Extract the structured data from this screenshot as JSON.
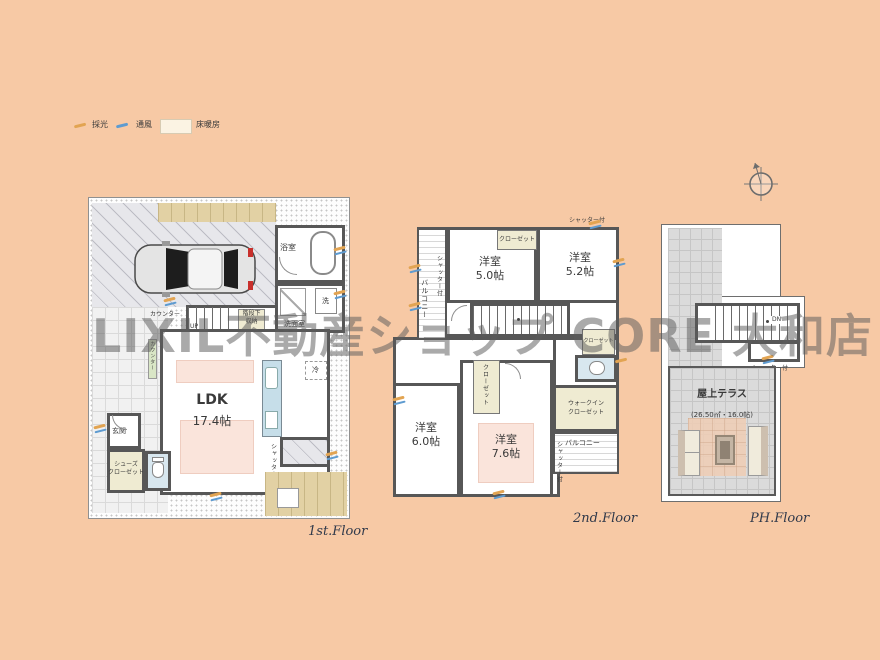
{
  "page": {
    "background": "#F7C9A5",
    "watermark": "LIXIL不動産ショップ CORE 大和店"
  },
  "legend": {
    "daylight": "採光",
    "ventilation": "通風",
    "floor_heating": "床暖房"
  },
  "floor1": {
    "label": "1st.Floor",
    "ldk": {
      "name": "LDK",
      "size": "17.4帖"
    },
    "bath": "浴室",
    "washroom": "洗面室",
    "washer": "洗",
    "under_stairs_line1": "階段下",
    "under_stairs_line2": "収納",
    "counter": "カウンター",
    "up": "UP",
    "entrance": "玄関",
    "shoe_closet_line1": "シューズ",
    "shoe_closet_line2": "クローゼット",
    "fridge": "冷",
    "shutter": "シャッター付"
  },
  "floor2": {
    "label": "2nd.Floor",
    "room_a": {
      "name": "洋室",
      "size": "5.0帖"
    },
    "room_b": {
      "name": "洋室",
      "size": "5.2帖"
    },
    "room_c": {
      "name": "洋室",
      "size": "6.0帖"
    },
    "room_d": {
      "name": "洋室",
      "size": "7.6帖"
    },
    "closet": "クローゼット",
    "wic_line1": "ウォークイン",
    "wic_line2": "クローゼット",
    "balcony": "バルコニー",
    "shutter": "シャッター付"
  },
  "floor_ph": {
    "label": "PH.Floor",
    "terrace": {
      "name": "屋上テラス",
      "size": "(26.50㎡・16.0帖)"
    },
    "down": "DN",
    "shutter": "シャッター付"
  }
}
